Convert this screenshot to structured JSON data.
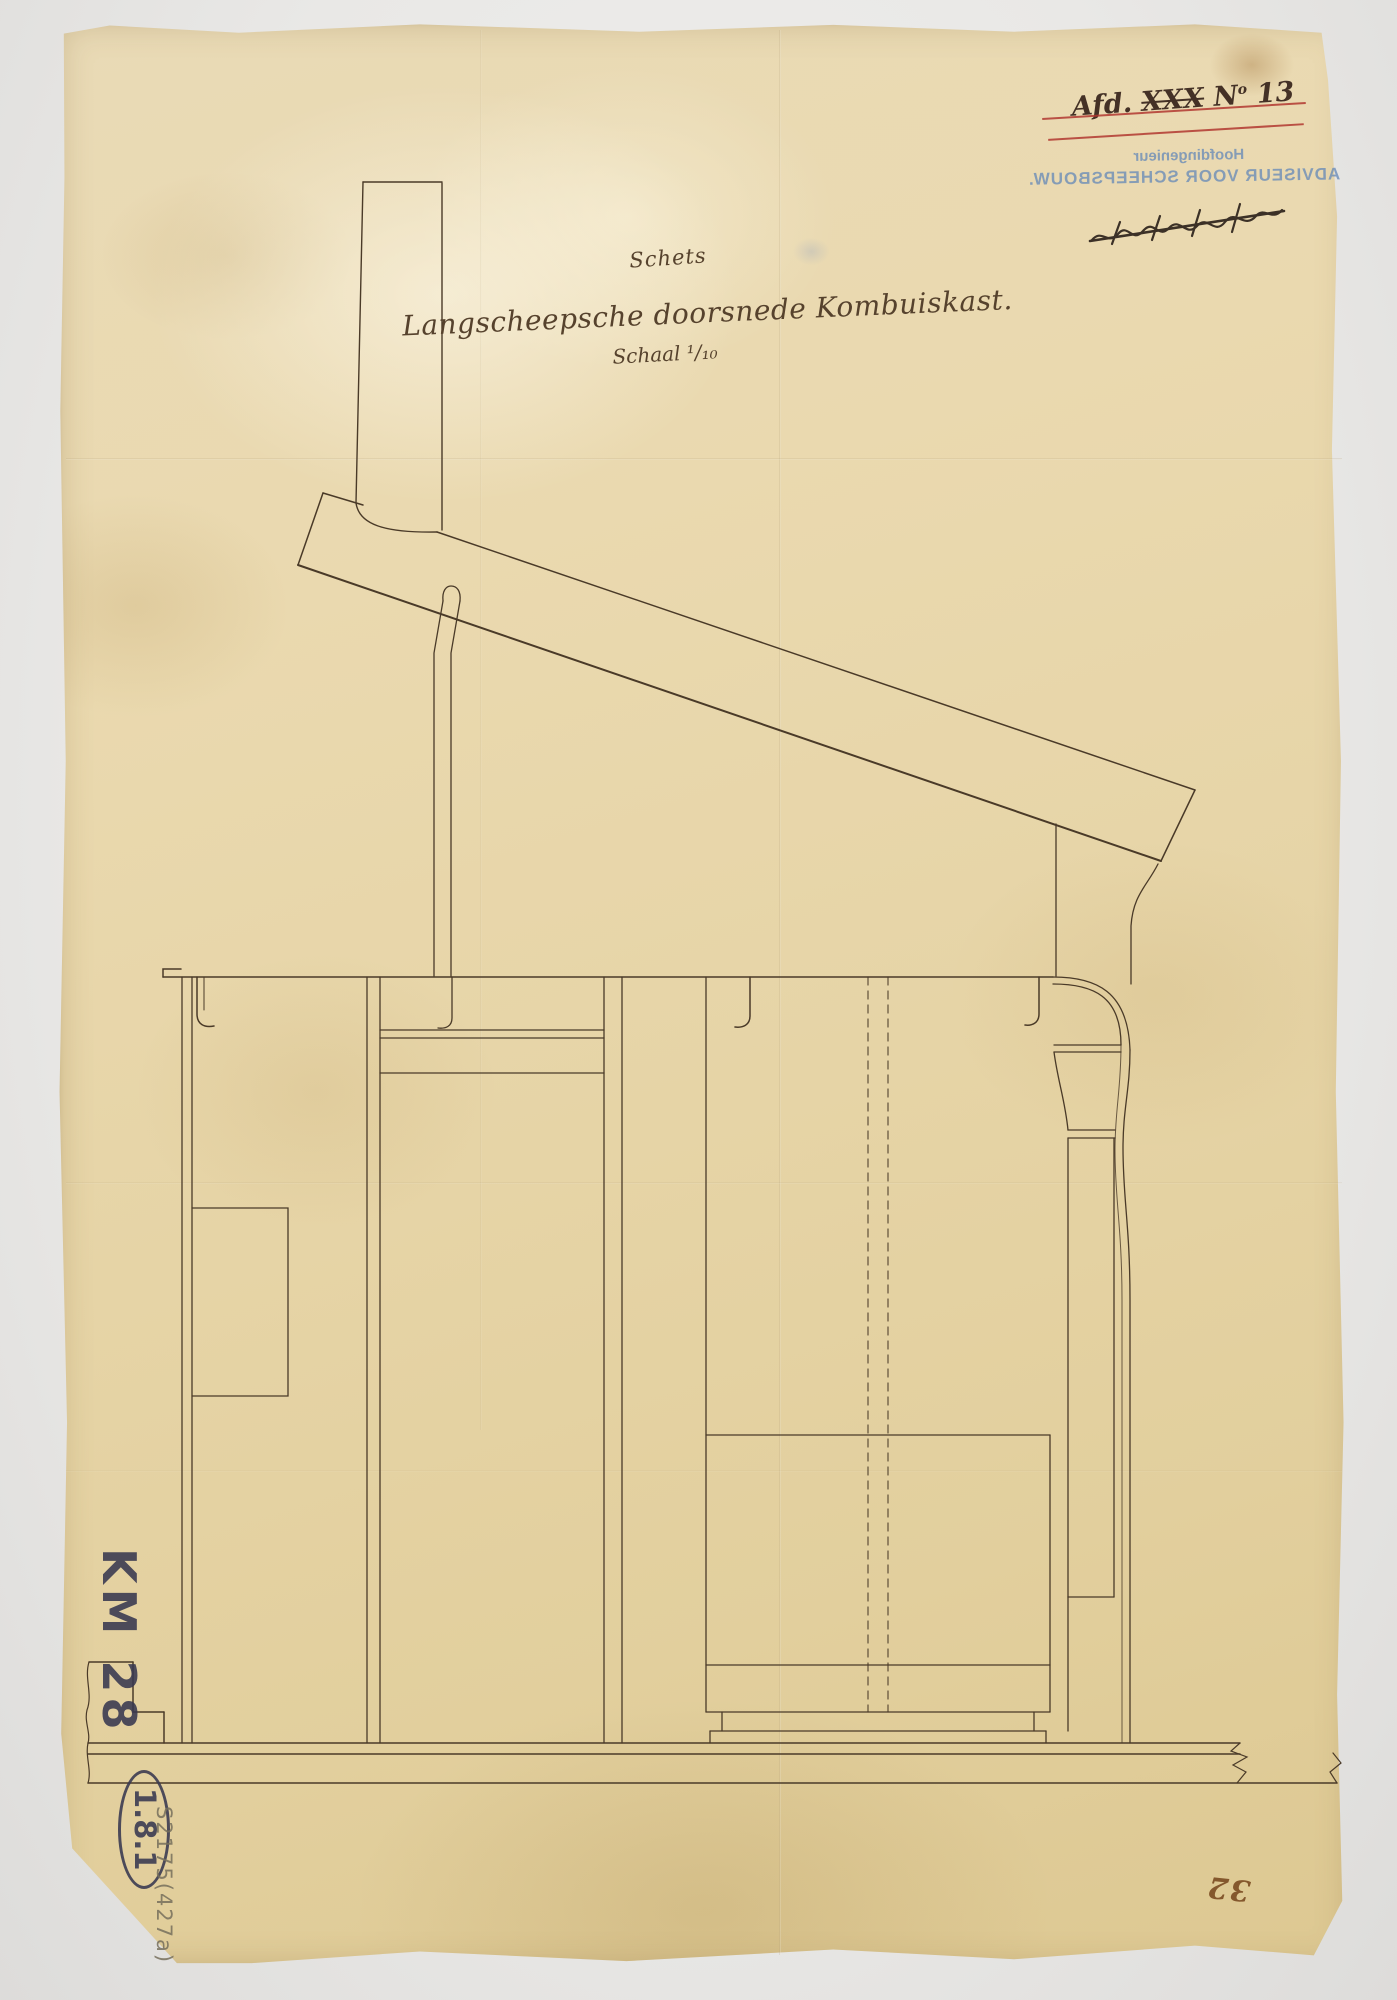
{
  "title_block": {
    "line1": "Schets",
    "line2": "Langscheepsche doorsnede Kombuiskast.",
    "line3": "Schaal ¹/₁₀"
  },
  "archival_mark": {
    "prefix": "Afd.",
    "crossed": "XXX",
    "n": "N",
    "n_sup": "o",
    "digits": "13",
    "strike_color": "#b23730"
  },
  "stamp": {
    "line1": "Hoofdingenieur",
    "line2": "ADVISEUR VOOR SCHEEPSBOUW.",
    "color": "#688ab7",
    "mirrored": true
  },
  "annotations": {
    "inventory_mark": "KM 28",
    "circled_mark": "1.8.1",
    "pencil_note": "S2175(427a)",
    "page_number": "32"
  },
  "drawing": {
    "subject": "Langsscheepsche doorsnede kombuiskast",
    "scale": "1:10",
    "ink_color": "#4a3a28",
    "paper_color": "#e8d7ac"
  }
}
